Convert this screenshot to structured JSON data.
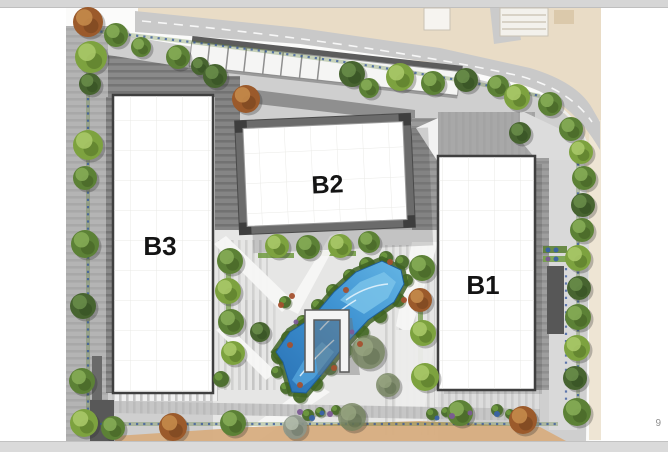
{
  "page": {
    "page_number": "9"
  },
  "site_plan": {
    "buildings": [
      {
        "label": "B3"
      },
      {
        "label": "B2"
      },
      {
        "label": "B1"
      }
    ],
    "colors": {
      "slide_edge": "#d8d8d8",
      "page_number_gray": "#8f8f8f",
      "road_gray": "#c9c9c9",
      "offsite_beige": "#e9dcc6",
      "sidewalk_cream": "#eee5d4",
      "pavement_light": "#e6e6e5",
      "pavement_mid": "#b4b4b4",
      "pavement_dark": "#7a7a7a",
      "walkway_tan": "#d7ad80",
      "building_white": "#ffffff",
      "building_outline": "#3f3f3f",
      "water_dark": "#2a72b5",
      "water_light": "#7cc4ea",
      "label_black": "#141414"
    },
    "landscape": {
      "tree_palette": {
        "g1": {
          "base": "#7da23f",
          "hi": "#a9c868",
          "dk": "#4e6b24",
          "op": 1
        },
        "g2": {
          "base": "#5c8136",
          "hi": "#85ab55",
          "dk": "#3d5a20",
          "op": 1
        },
        "g3": {
          "base": "#476430",
          "hi": "#688c49",
          "dk": "#2f4a1d",
          "op": 1
        },
        "g4": {
          "base": "#76855f",
          "hi": "#9aa882",
          "dk": "#556446",
          "op": 0.8
        },
        "or": {
          "base": "#9b5a2b",
          "hi": "#c48a4a",
          "dk": "#6e3d1b",
          "op": 1
        },
        "pm": {
          "base": "#8d978a",
          "hi": "#b5bfae",
          "dk": "#646e62",
          "op": 0.9
        }
      },
      "trees": [
        [
          88,
          22,
          15,
          "or"
        ],
        [
          116,
          35,
          12,
          "g2"
        ],
        [
          91,
          57,
          16,
          "g1"
        ],
        [
          90,
          84,
          11,
          "g3"
        ],
        [
          141,
          47,
          10,
          "g2"
        ],
        [
          178,
          57,
          12,
          "g2"
        ],
        [
          200,
          66,
          9,
          "g3"
        ],
        [
          215,
          76,
          12,
          "g3"
        ],
        [
          246,
          99,
          14,
          "or"
        ],
        [
          352,
          74,
          13,
          "g3"
        ],
        [
          369,
          88,
          10,
          "g2"
        ],
        [
          400,
          77,
          14,
          "g1"
        ],
        [
          433,
          83,
          12,
          "g2"
        ],
        [
          466,
          80,
          12,
          "g3"
        ],
        [
          498,
          86,
          11,
          "g2"
        ],
        [
          517,
          97,
          13,
          "g1"
        ],
        [
          550,
          104,
          12,
          "g2"
        ],
        [
          520,
          133,
          11,
          "g3"
        ],
        [
          571,
          129,
          12,
          "g2"
        ],
        [
          581,
          152,
          12,
          "g1"
        ],
        [
          584,
          178,
          12,
          "g2"
        ],
        [
          583,
          205,
          12,
          "g3"
        ],
        [
          582,
          230,
          12,
          "g2"
        ],
        [
          578,
          258,
          13,
          "g1"
        ],
        [
          579,
          288,
          12,
          "g3"
        ],
        [
          578,
          317,
          13,
          "g2"
        ],
        [
          577,
          348,
          13,
          "g1"
        ],
        [
          575,
          378,
          12,
          "g3"
        ],
        [
          577,
          412,
          14,
          "g2"
        ],
        [
          523,
          420,
          14,
          "or"
        ],
        [
          460,
          413,
          13,
          "g2"
        ],
        [
          352,
          417,
          14,
          "g4"
        ],
        [
          295,
          427,
          12,
          "pm"
        ],
        [
          233,
          423,
          13,
          "g2"
        ],
        [
          173,
          427,
          14,
          "or"
        ],
        [
          113,
          428,
          12,
          "g2"
        ],
        [
          84,
          423,
          14,
          "g1"
        ],
        [
          88,
          145,
          15,
          "g1"
        ],
        [
          85,
          178,
          12,
          "g2"
        ],
        [
          85,
          244,
          14,
          "g2"
        ],
        [
          83,
          306,
          13,
          "g3"
        ],
        [
          82,
          381,
          13,
          "g2"
        ],
        [
          277,
          246,
          12,
          "g1"
        ],
        [
          308,
          247,
          12,
          "g2"
        ],
        [
          340,
          246,
          12,
          "g1"
        ],
        [
          369,
          242,
          11,
          "g2"
        ],
        [
          230,
          261,
          13,
          "g2"
        ],
        [
          228,
          291,
          13,
          "g1"
        ],
        [
          231,
          322,
          13,
          "g2"
        ],
        [
          233,
          353,
          12,
          "g1"
        ],
        [
          260,
          332,
          10,
          "g3"
        ],
        [
          422,
          268,
          13,
          "g2"
        ],
        [
          420,
          300,
          12,
          "or"
        ],
        [
          423,
          333,
          13,
          "g1"
        ],
        [
          425,
          377,
          14,
          "g1"
        ],
        [
          368,
          352,
          17,
          "g4"
        ],
        [
          388,
          385,
          12,
          "g4"
        ]
      ],
      "shrub_color": "#4a6d2b",
      "shrubs": [
        [
          279,
          356,
          8
        ],
        [
          288,
          338,
          7
        ],
        [
          303,
          322,
          7
        ],
        [
          318,
          306,
          7
        ],
        [
          333,
          291,
          7
        ],
        [
          350,
          276,
          7
        ],
        [
          367,
          265,
          8
        ],
        [
          386,
          258,
          7
        ],
        [
          402,
          262,
          7
        ],
        [
          407,
          280,
          6
        ],
        [
          398,
          300,
          7
        ],
        [
          380,
          316,
          7
        ],
        [
          362,
          332,
          7
        ],
        [
          346,
          350,
          7
        ],
        [
          330,
          368,
          7
        ],
        [
          316,
          384,
          7
        ],
        [
          300,
          396,
          7
        ],
        [
          286,
          388,
          6
        ],
        [
          277,
          372,
          6
        ],
        [
          308,
          415,
          6
        ],
        [
          320,
          412,
          5
        ],
        [
          336,
          410,
          5
        ],
        [
          432,
          414,
          6
        ],
        [
          446,
          412,
          5
        ],
        [
          497,
          410,
          6
        ],
        [
          510,
          414,
          5
        ],
        [
          221,
          379,
          8
        ],
        [
          285,
          302,
          6
        ]
      ],
      "accent_colors": {
        "red": "#a4512f",
        "purple": "#7b5a95",
        "blue": "#3a62a8"
      },
      "accents": [
        [
          281,
          305,
          3,
          "red"
        ],
        [
          290,
          345,
          3,
          "red"
        ],
        [
          300,
          385,
          3,
          "red"
        ],
        [
          346,
          290,
          3,
          "red"
        ],
        [
          360,
          344,
          3,
          "red"
        ],
        [
          390,
          262,
          3,
          "red"
        ],
        [
          404,
          300,
          3,
          "red"
        ],
        [
          334,
          368,
          3,
          "red"
        ],
        [
          292,
          296,
          3,
          "red"
        ],
        [
          296,
          322,
          2.5,
          "purple"
        ],
        [
          352,
          332,
          2.5,
          "purple"
        ],
        [
          300,
          412,
          3,
          "purple"
        ],
        [
          330,
          414,
          3,
          "purple"
        ],
        [
          452,
          416,
          3,
          "purple"
        ],
        [
          470,
          413,
          2.5,
          "purple"
        ],
        [
          312,
          418,
          3,
          "blue"
        ],
        [
          322,
          413,
          2.5,
          "blue"
        ],
        [
          437,
          418,
          2.5,
          "blue"
        ],
        [
          497,
          414,
          3,
          "blue"
        ],
        [
          548,
          250,
          2.5,
          "blue"
        ],
        [
          556,
          250,
          2.5,
          "blue"
        ],
        [
          548,
          259,
          2.5,
          "purple"
        ],
        [
          556,
          259,
          2.5,
          "blue"
        ]
      ]
    }
  }
}
